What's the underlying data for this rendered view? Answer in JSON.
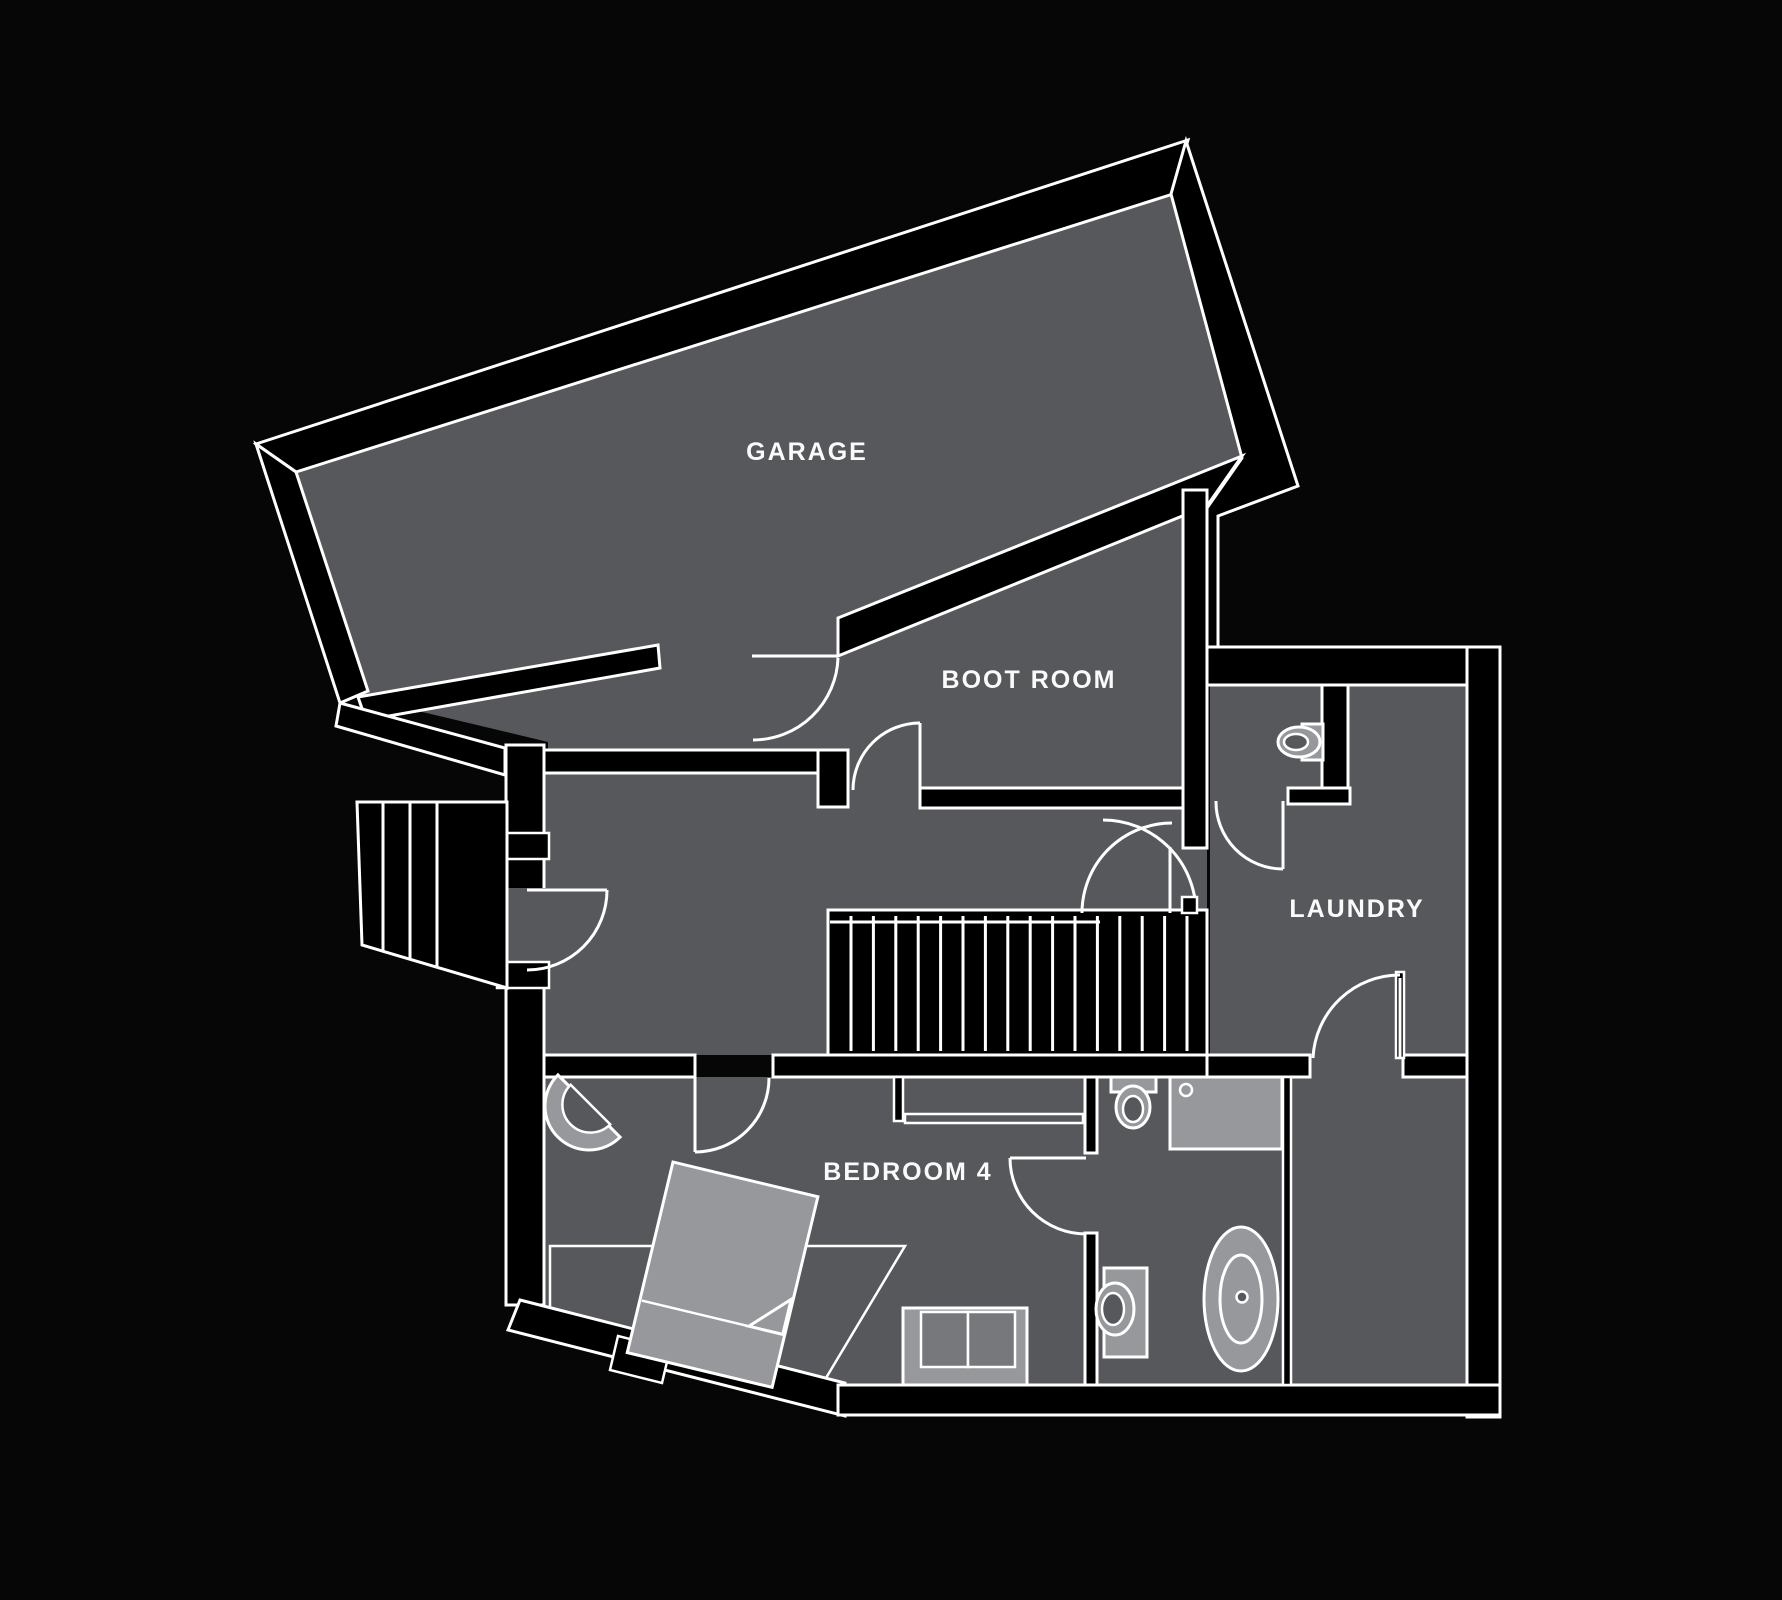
{
  "plan": {
    "title": "Lower floor plan",
    "rooms": {
      "garage": {
        "label": "GARAGE"
      },
      "boot_room": {
        "label": "BOOT ROOM"
      },
      "laundry": {
        "label": "LAUNDRY"
      },
      "bedroom4": {
        "label": "BEDROOM 4"
      }
    },
    "stairs": {
      "main_tread_count": 16,
      "outdoor_step_count": 4
    },
    "fixtures": [
      "corner-sink",
      "toilet-wc",
      "toilet-top",
      "shower-tray",
      "toilet-bottom",
      "bathtub",
      "bed",
      "rug",
      "sofa",
      "console"
    ],
    "theme": {
      "background": "#060606",
      "wall": "#000000",
      "room_fill": "#56585b",
      "fixture_light": "#97989b",
      "cushion": "#76787b",
      "line": "#ffffff",
      "text": "#fafafa"
    }
  }
}
